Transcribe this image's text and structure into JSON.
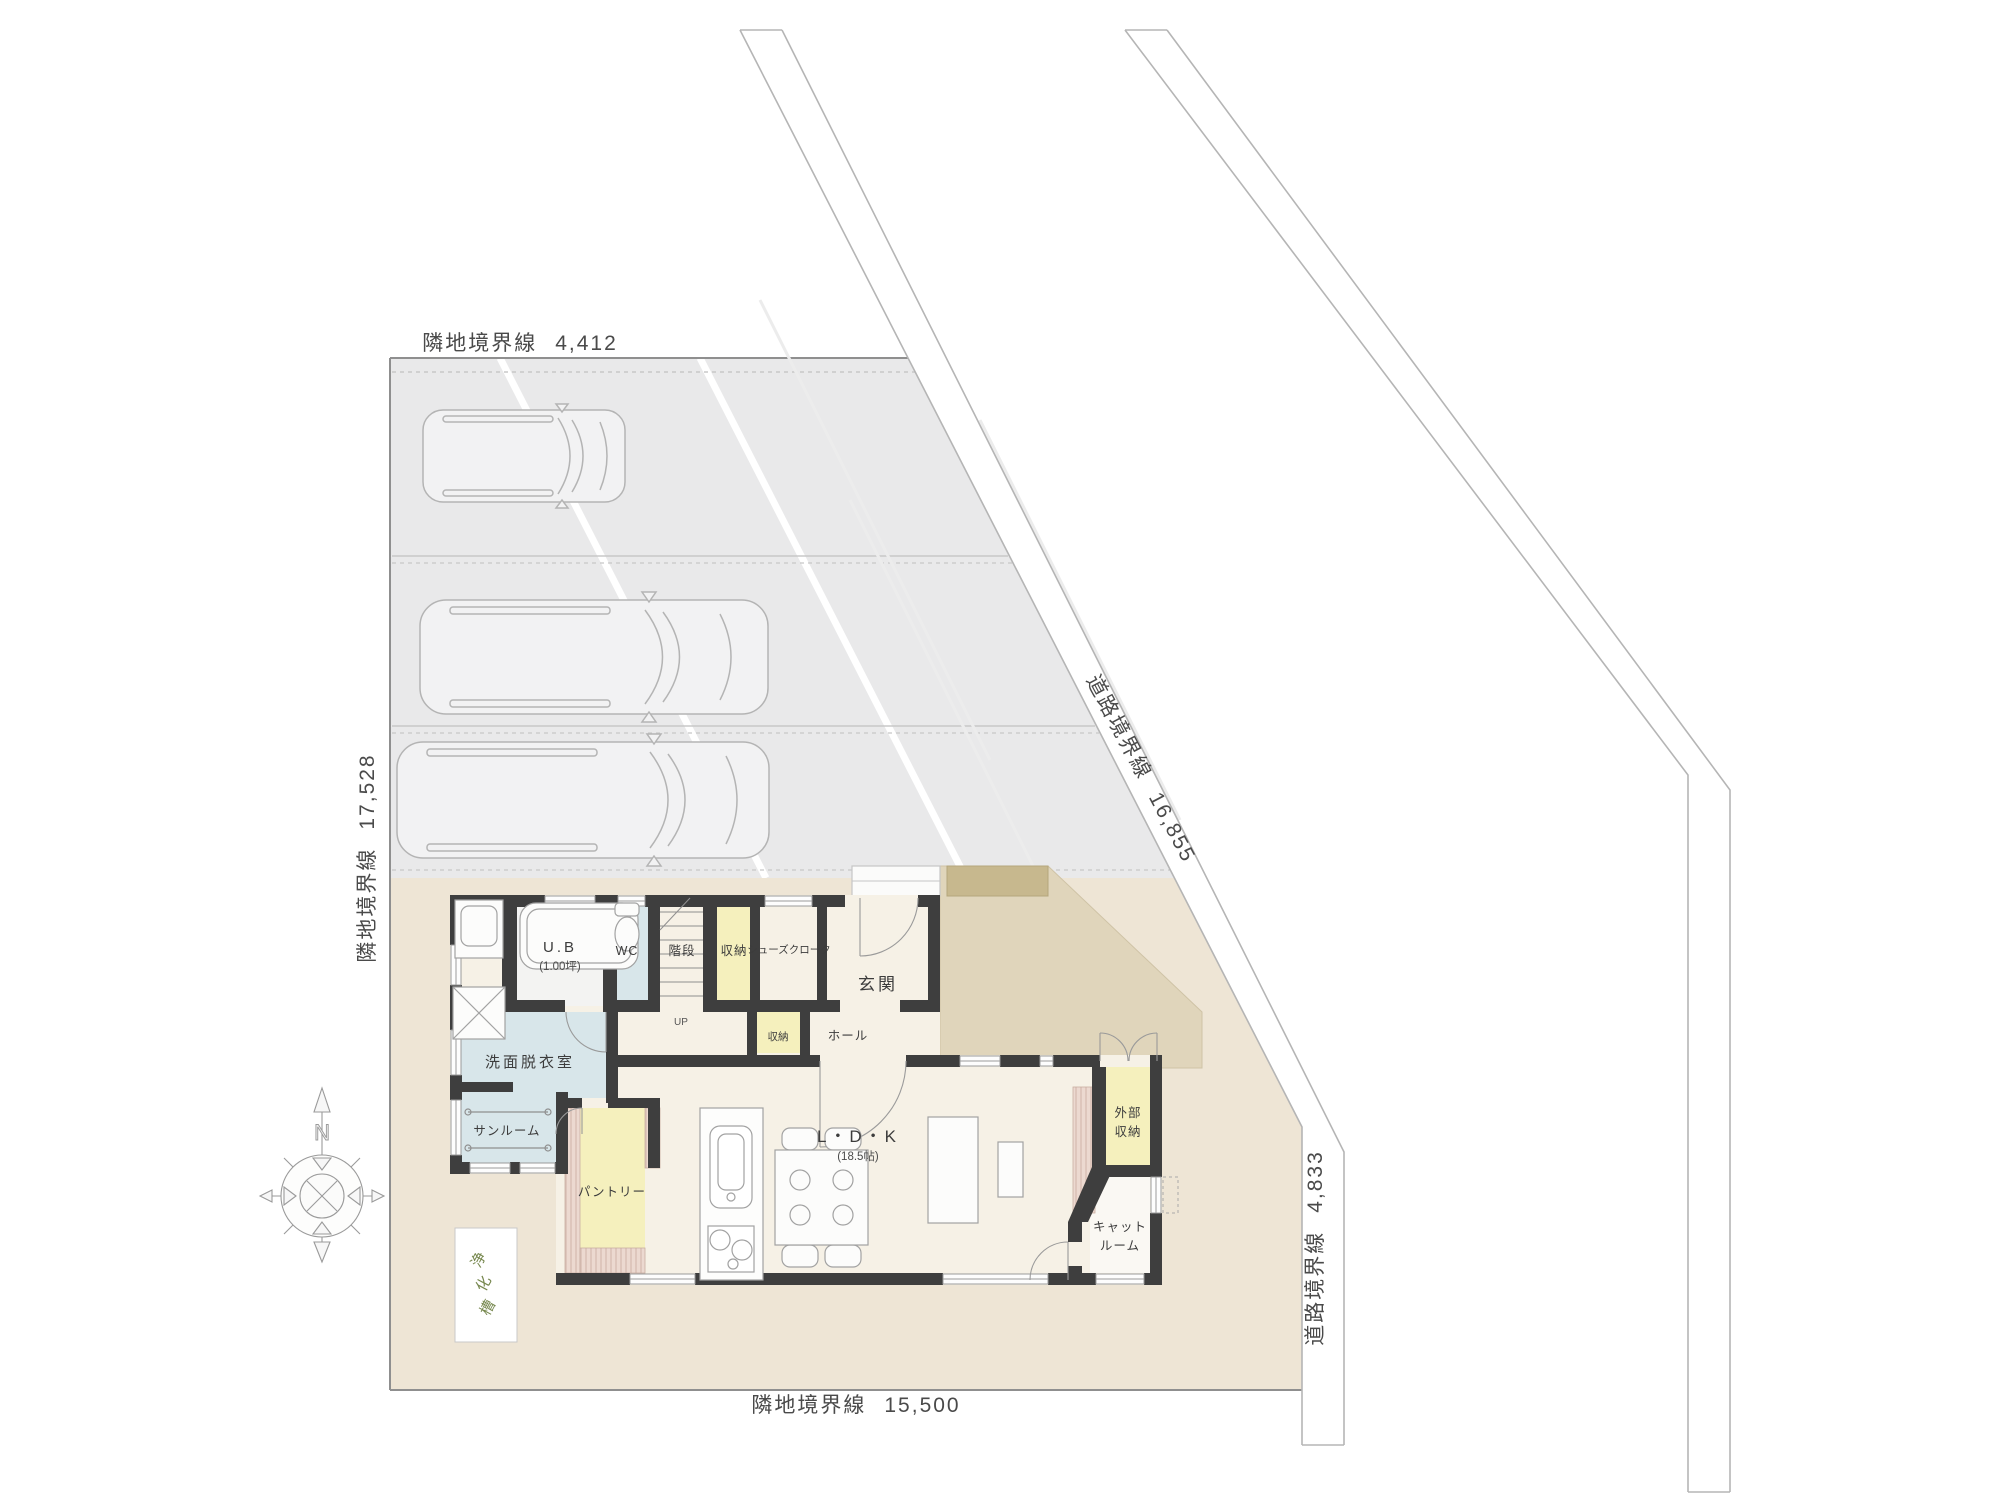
{
  "title": "敷地配置図・1階平面図",
  "boundaries": {
    "top": {
      "label": "隣地境界線",
      "value": "4,412"
    },
    "left": {
      "label": "隣地境界線",
      "value": "17,528"
    },
    "bottom": {
      "label": "隣地境界線",
      "value": "15,500"
    },
    "right": {
      "label": "道路境界線",
      "value": "4,833"
    },
    "road": {
      "label": "道路境界線",
      "value": "16,855"
    }
  },
  "rooms": {
    "ub": {
      "name": "U.B",
      "size": "(1.00坪)"
    },
    "wc": {
      "name": "WC"
    },
    "stairs": {
      "name": "階段",
      "direction": "UP"
    },
    "storage_upper": {
      "name": "収納"
    },
    "shoe_closet": {
      "name": "シューズクローク"
    },
    "entrance": {
      "name": "玄関"
    },
    "storage_hall": {
      "name": "収納"
    },
    "hall": {
      "name": "ホール"
    },
    "washroom": {
      "name": "洗面脱衣室"
    },
    "sunroom": {
      "name": "サンルーム"
    },
    "pantry": {
      "name": "パントリー"
    },
    "ldk": {
      "name": "L・D・K",
      "size": "(18.5帖)"
    },
    "ext_storage": {
      "line1": "外部",
      "line2": "収納"
    },
    "cat_room": {
      "line1": "キャット",
      "line2": "ルーム"
    }
  },
  "site": {
    "septic": {
      "c1": "浄",
      "c2": "化",
      "c3": "槽"
    },
    "compass_north": "N",
    "parking_spaces": 3
  },
  "colors": {
    "wall": "#3e3e3e",
    "parking": "#e9e9ea",
    "site_beige": "#eee5d5",
    "terrace_tan": "#e0d5bb",
    "step_brown": "#c7b88e",
    "room_yellow": "#f5f0bd",
    "room_blue": "#d8e6ea",
    "floor_cream": "#f6f1e6",
    "stripe_pink": "#ecd9d0",
    "line_gray": "#b5b5b5",
    "septic_green": "#77884f"
  }
}
